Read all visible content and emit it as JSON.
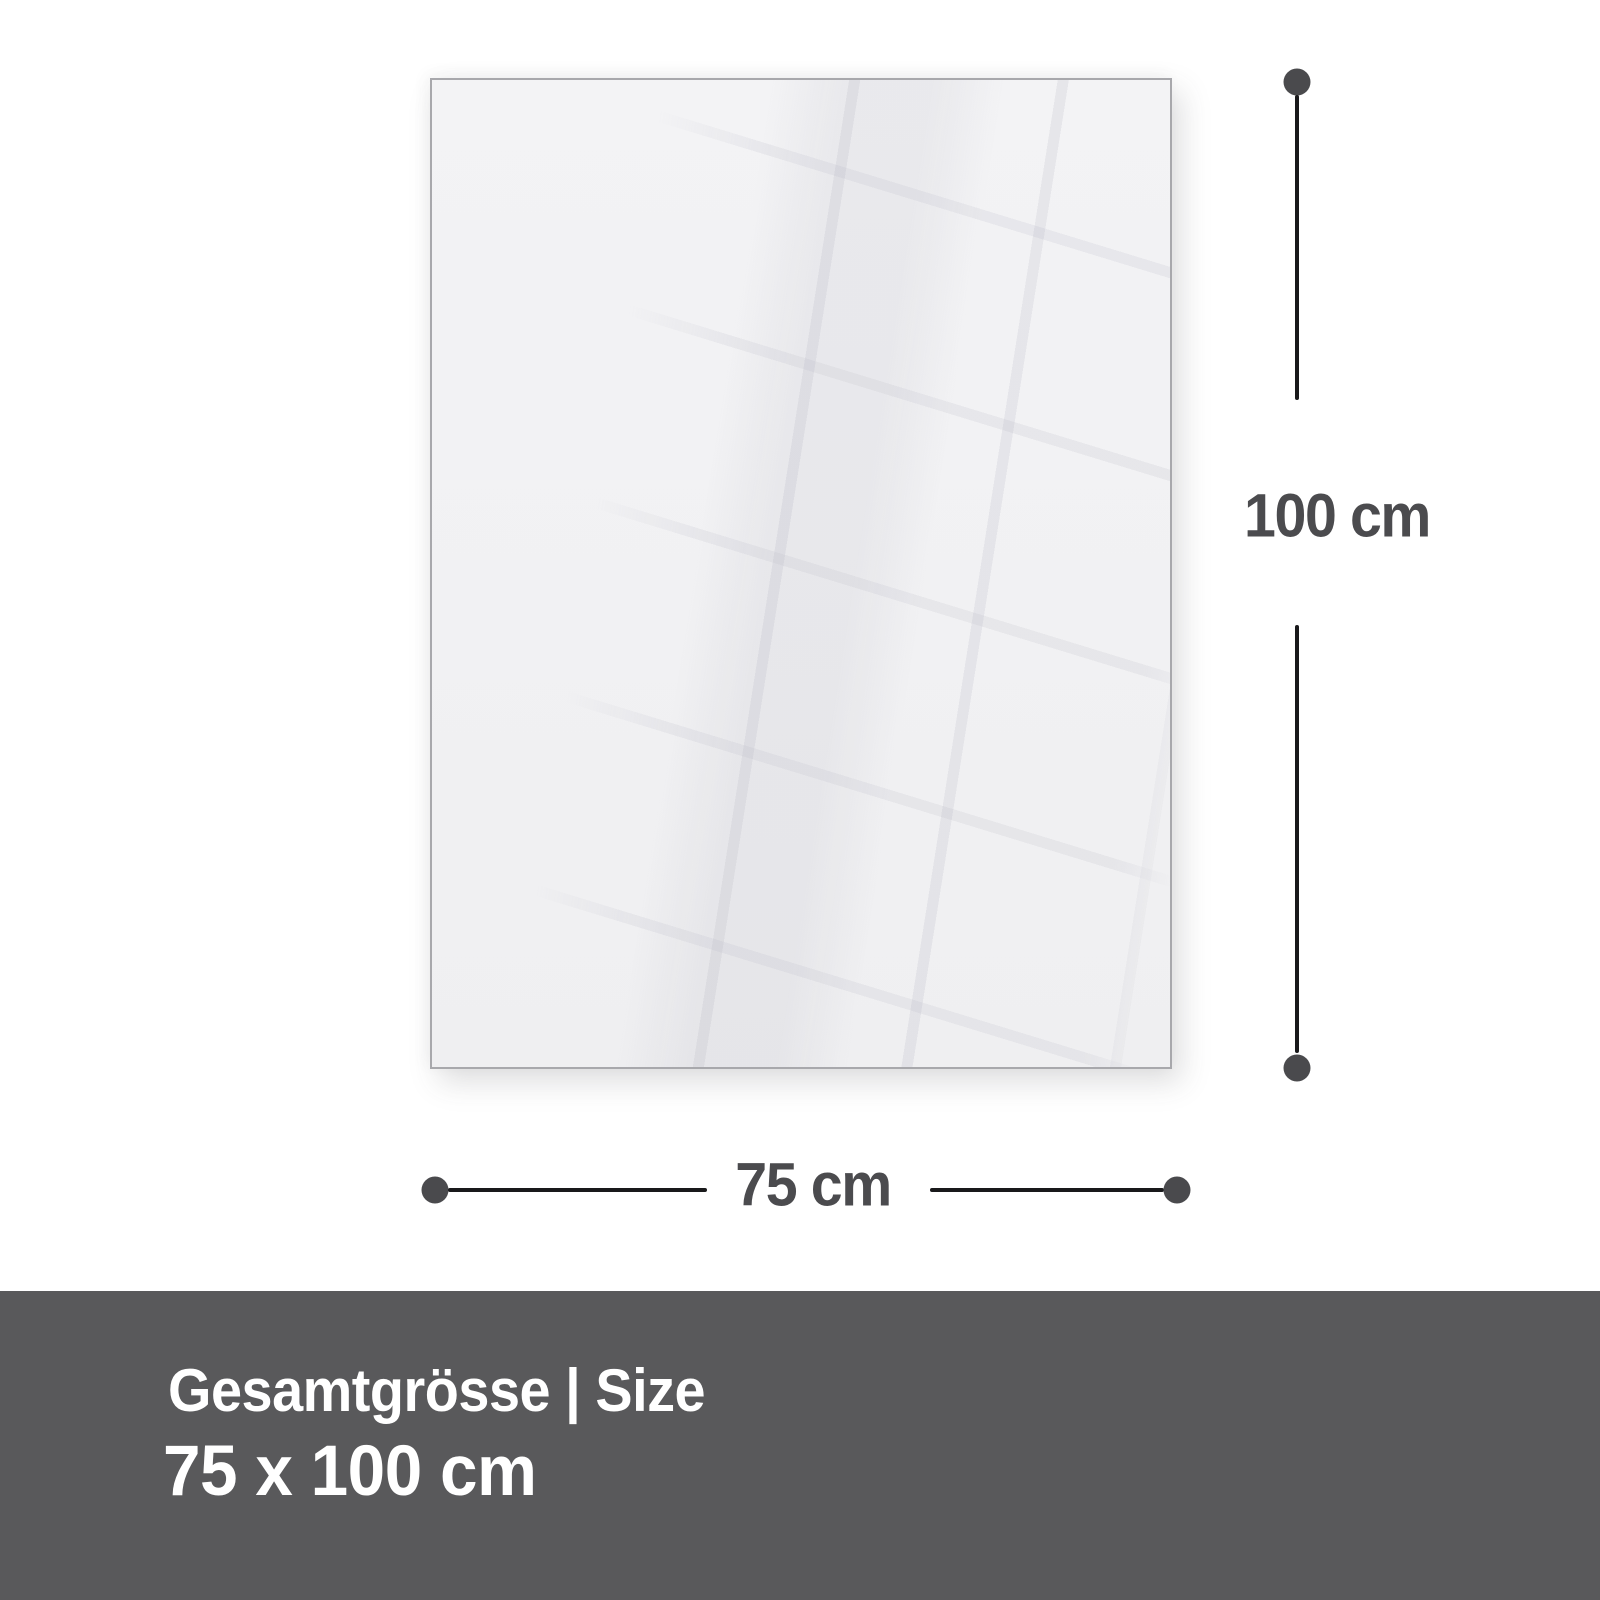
{
  "page": {
    "background": "#ffffff",
    "description": "Product size infographic for a blank glossy panel"
  },
  "panel": {
    "fill": "#f2f2f4",
    "border_color": "#a8a8ac",
    "reflection": "diagonal window-grid reflection, subtle"
  },
  "dimensions": {
    "height": {
      "label": "100 cm"
    },
    "width": {
      "label": "75 cm"
    },
    "line_color": "#19191b",
    "dot_color": "#4a4a4d",
    "label_color": "#4b4b4e"
  },
  "footer": {
    "title": "Gesamtgrösse | Size",
    "size": "75 x 100 cm",
    "background": "#59595b",
    "text_color": "#ffffff"
  }
}
